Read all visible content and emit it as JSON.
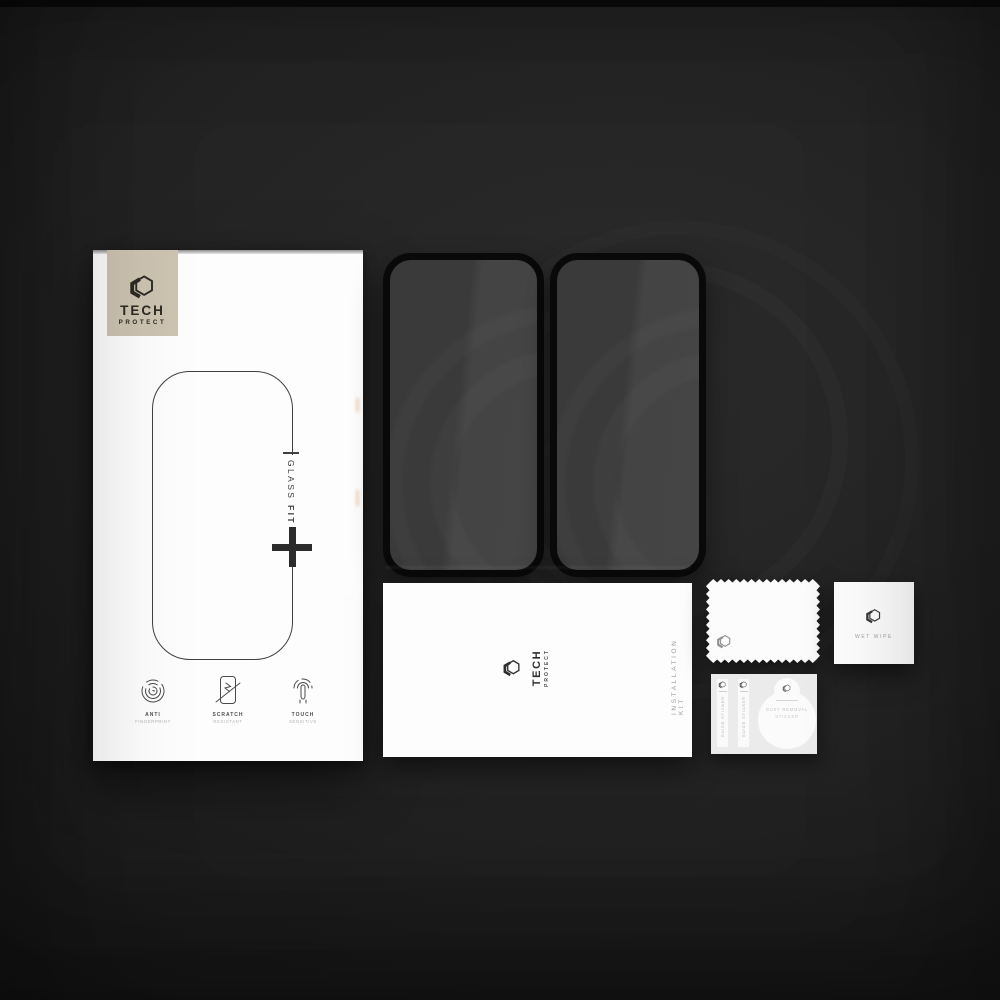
{
  "colors": {
    "background": "#1f1f1f",
    "logo_panel_beige": "#cdc3b1",
    "box_white": "#fdfdfd",
    "glass_frame_black": "#0a0a0a",
    "glass_tint_gray": "#3f3f3f",
    "dark_text": "#3a3a3a",
    "muted_text": "#9b9b9b"
  },
  "box": {
    "brand": {
      "line1": "TECH",
      "line2": "PROTECT"
    },
    "product": {
      "word1": "GLASS",
      "word2": "FIT"
    },
    "features": [
      {
        "icon": "fingerprint-icon",
        "line1": "ANTI",
        "line2": "FINGERPRINT"
      },
      {
        "icon": "scratch-shield-icon",
        "line1": "SCRATCH",
        "line2": "RESISTANT"
      },
      {
        "icon": "touch-icon",
        "line1": "TOUCH",
        "line2": "SENSITIVE"
      }
    ]
  },
  "installation_kit": {
    "brand": {
      "line1": "TECH",
      "line2": "PROTECT"
    },
    "side_label": "INSTALLATION KIT"
  },
  "wet_wipe": {
    "label": "WET WIPE"
  },
  "sticker_sheet": {
    "guide_stickers": [
      {
        "label": "GUIDE STICKER"
      },
      {
        "label": "GUIDE STICKER"
      }
    ],
    "dust_removal_sticker": {
      "line1": "DUST REMOVAL",
      "line2": "STICKER"
    }
  }
}
